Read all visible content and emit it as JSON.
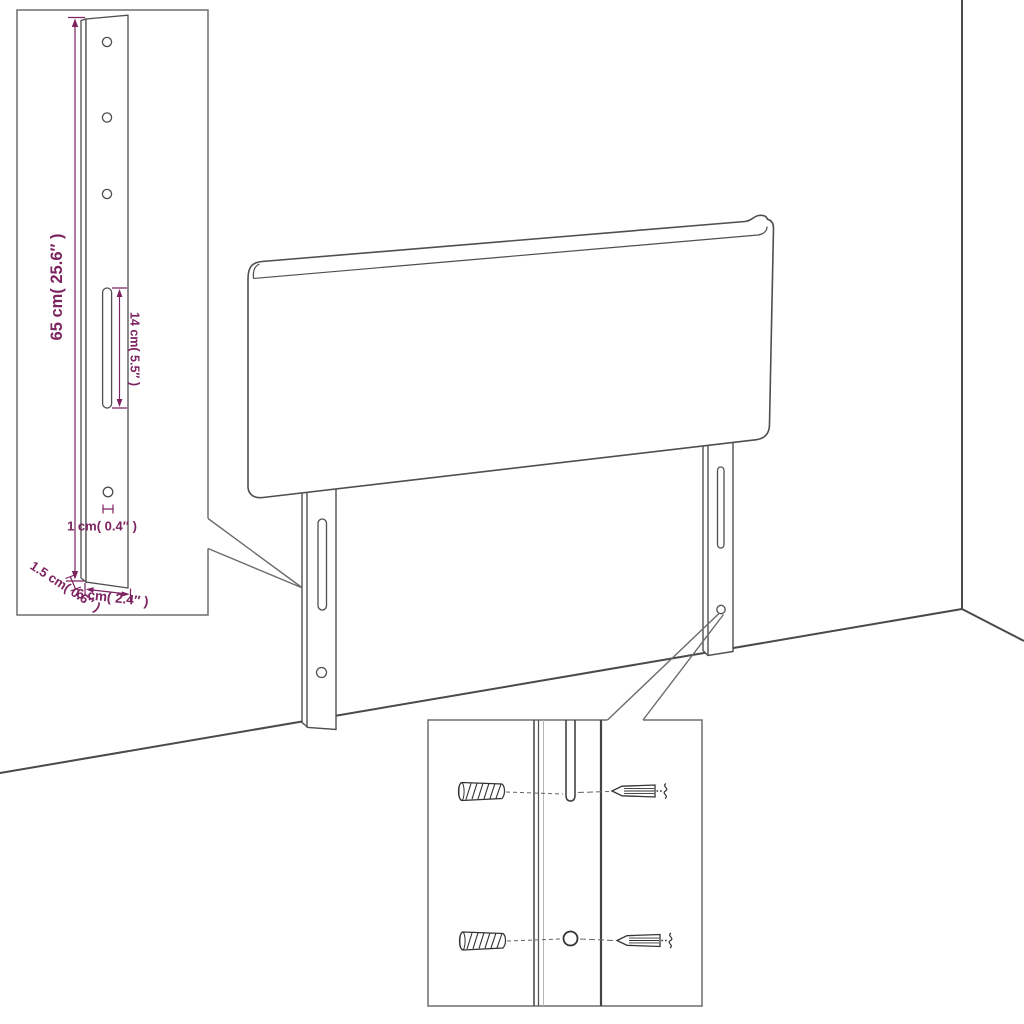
{
  "diagram": {
    "title": "Headboard with adjustable slotted legs - assembly dimension diagram",
    "colors": {
      "background": "#ffffff",
      "drawing_line": "#4f4f4f",
      "dimension_accent": "#7c2360",
      "inset_border": "#6e6e6e"
    },
    "insets": {
      "leg_detail": {
        "dims": {
          "height": "65 cm( 25.6″ )",
          "slot_length": "14 cm( 5.5″ )",
          "hole_width": "1 cm( 0.4″ )",
          "thickness": "1.5 cm( 0.6″ )",
          "width": "6 cm( 2.4″ )"
        }
      },
      "hardware_detail": {
        "parts": [
          "wall-plug",
          "screw",
          "keyhole-slot",
          "mounting-hole"
        ]
      }
    }
  }
}
